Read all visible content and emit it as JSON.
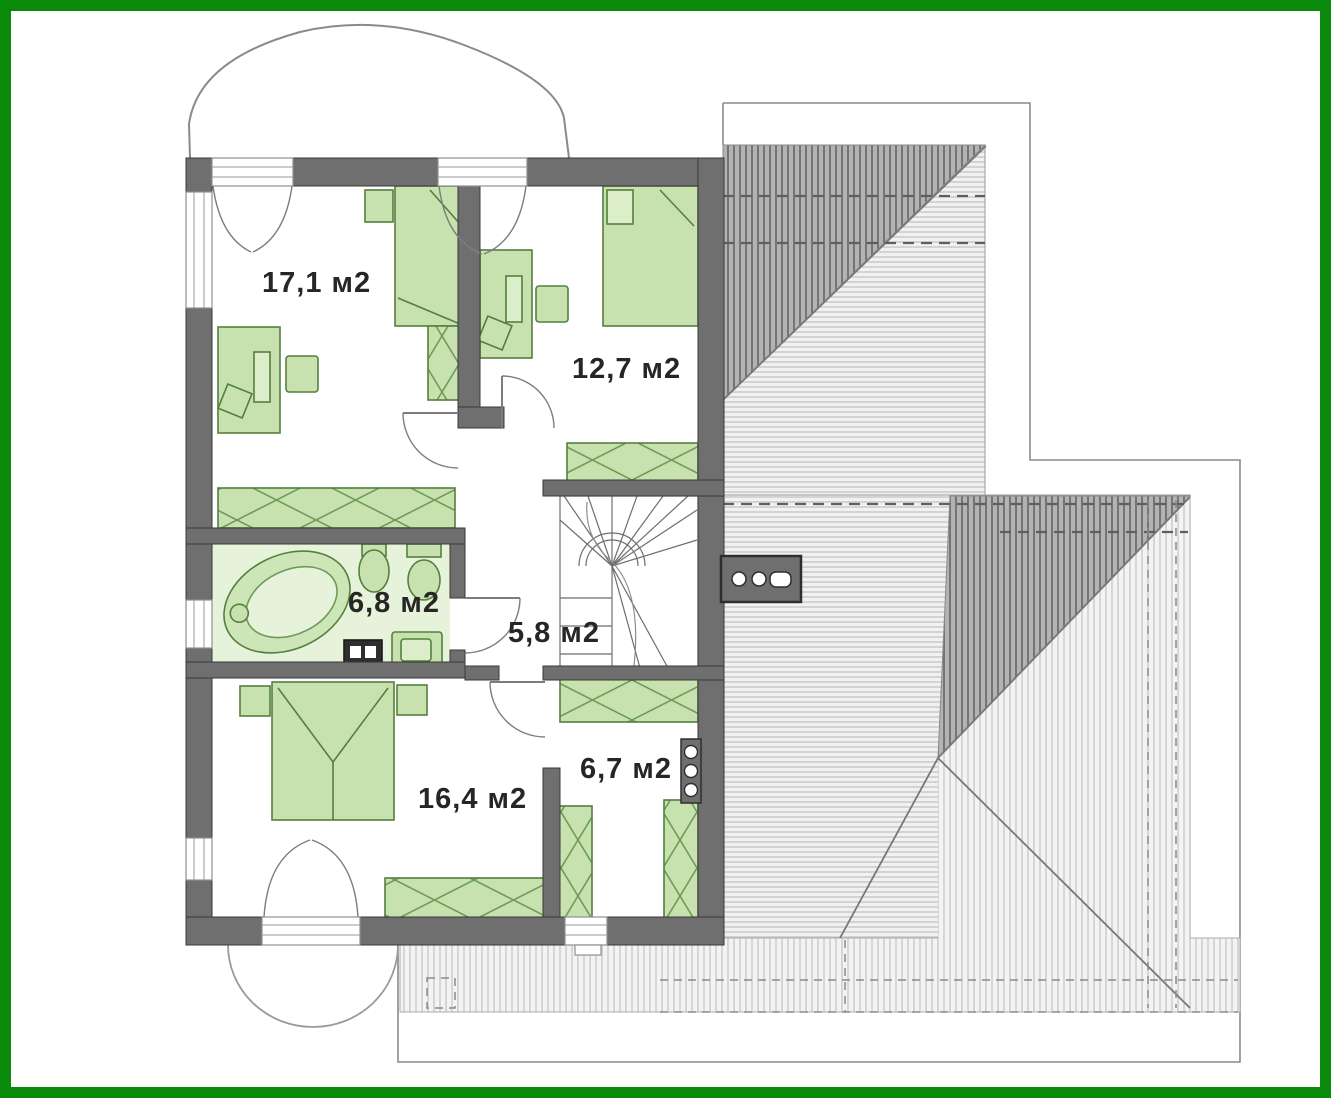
{
  "meta": {
    "drawing_type": "floor plan with roof plan",
    "floor": "attic / second floor",
    "area_unit": "м2"
  },
  "frame": {
    "border_color": "#0a8a0a",
    "background": "#ffffff"
  },
  "rooms": [
    {
      "id": "bedroom-top-left",
      "area_label": "17,1 м2"
    },
    {
      "id": "bedroom-top-right",
      "area_label": "12,7 м2"
    },
    {
      "id": "bathroom",
      "area_label": "6,8 м2"
    },
    {
      "id": "stair-hall",
      "area_label": "5,8 м2"
    },
    {
      "id": "bedroom-bottom",
      "area_label": "16,4 м2"
    },
    {
      "id": "wardrobe-room",
      "area_label": "6,7 м2"
    }
  ],
  "furniture": [
    "single-bed",
    "desk",
    "chair",
    "plant",
    "wardrobe",
    "bathtub",
    "sink",
    "toilet",
    "washing-machine",
    "vanity-cabinet",
    "double-bed",
    "nightstand",
    "winder-stairs",
    "chimney"
  ],
  "colors": {
    "wall": "#6f6f6f",
    "wall_outline": "#3a3a3a",
    "furniture_fill": "#c7e2ae",
    "furniture_stroke": "#557f3f",
    "bathroom_floor": "#e7f2da",
    "roof_dark_fill": "#b3b3b3",
    "roof_dark_line": "#757575",
    "roof_light_fill": "#f1f1f1",
    "roof_light_line": "#bfbfbf",
    "thin_outline": "#8a8a8a"
  }
}
